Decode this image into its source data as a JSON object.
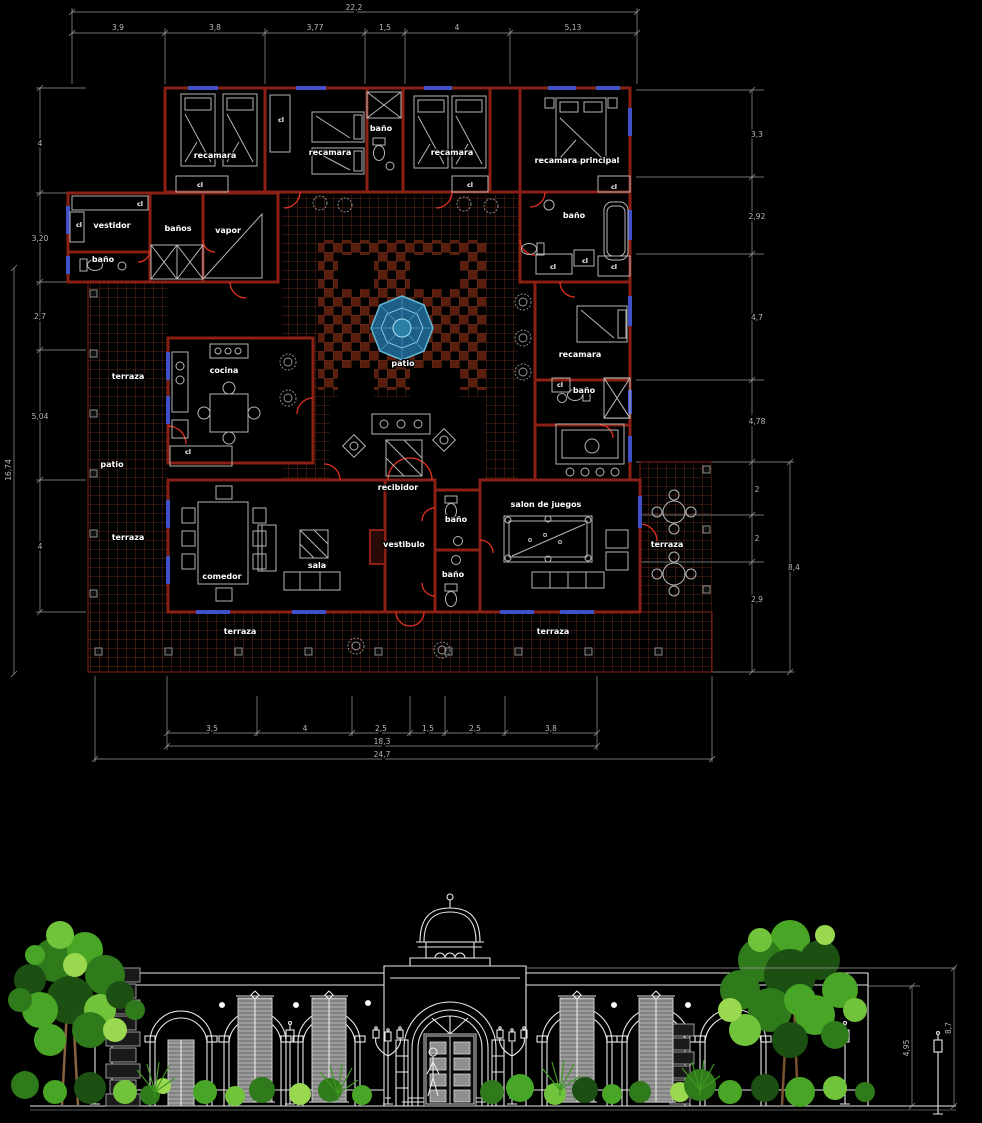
{
  "background": "#000000",
  "plan": {
    "labels": [
      "recamara",
      "recamara",
      "baño",
      "recamara",
      "recamara principal",
      "vestidor",
      "baño",
      "baños",
      "vapor",
      "baño",
      "recamara",
      "baño",
      "cocina",
      "patio",
      "recibidor",
      "vestibulo",
      "baño",
      "baño",
      "comedor",
      "sala",
      "salon de juegos",
      "terraza",
      "patio",
      "terraza",
      "terraza",
      "terraza",
      "terraza"
    ],
    "closet_label": "cl",
    "dims": {
      "top_total": "22,2",
      "top": [
        "3,9",
        "3,8",
        "3,77",
        "1,5",
        "4",
        "5,13"
      ],
      "left": [
        "4",
        "3,20",
        "2,7",
        "5,04",
        "4"
      ],
      "left_total": "16,74",
      "right": [
        "3,3",
        "2,92",
        "4,7",
        "4,78",
        "2",
        "2",
        "2,9"
      ],
      "right_total": "8,4",
      "bottom": [
        "3,5",
        "4",
        "2,5",
        "1,5",
        "2,5",
        "3,8"
      ],
      "bottom_subtotal": "18,3",
      "bottom_total": "24,7"
    }
  },
  "elevation": {
    "dims": {
      "inner_height": "4,95",
      "total_height": "8,7"
    }
  },
  "colors": {
    "wall_red": "#8c2014",
    "door_red": "#e23222",
    "tile_brown": "#74301a",
    "fountain_blue": "#1d5f86",
    "furniture_gray": "#b5b5b5",
    "dimension_gray": "#9a9a9a",
    "label_white": "#ffffff",
    "window_blue": "#3f51c8",
    "facade_white": "#e9e9e9",
    "foliage_greens": [
      "#1c4f12",
      "#2f7a1b",
      "#49a526",
      "#71c33b",
      "#9ad84f"
    ]
  }
}
